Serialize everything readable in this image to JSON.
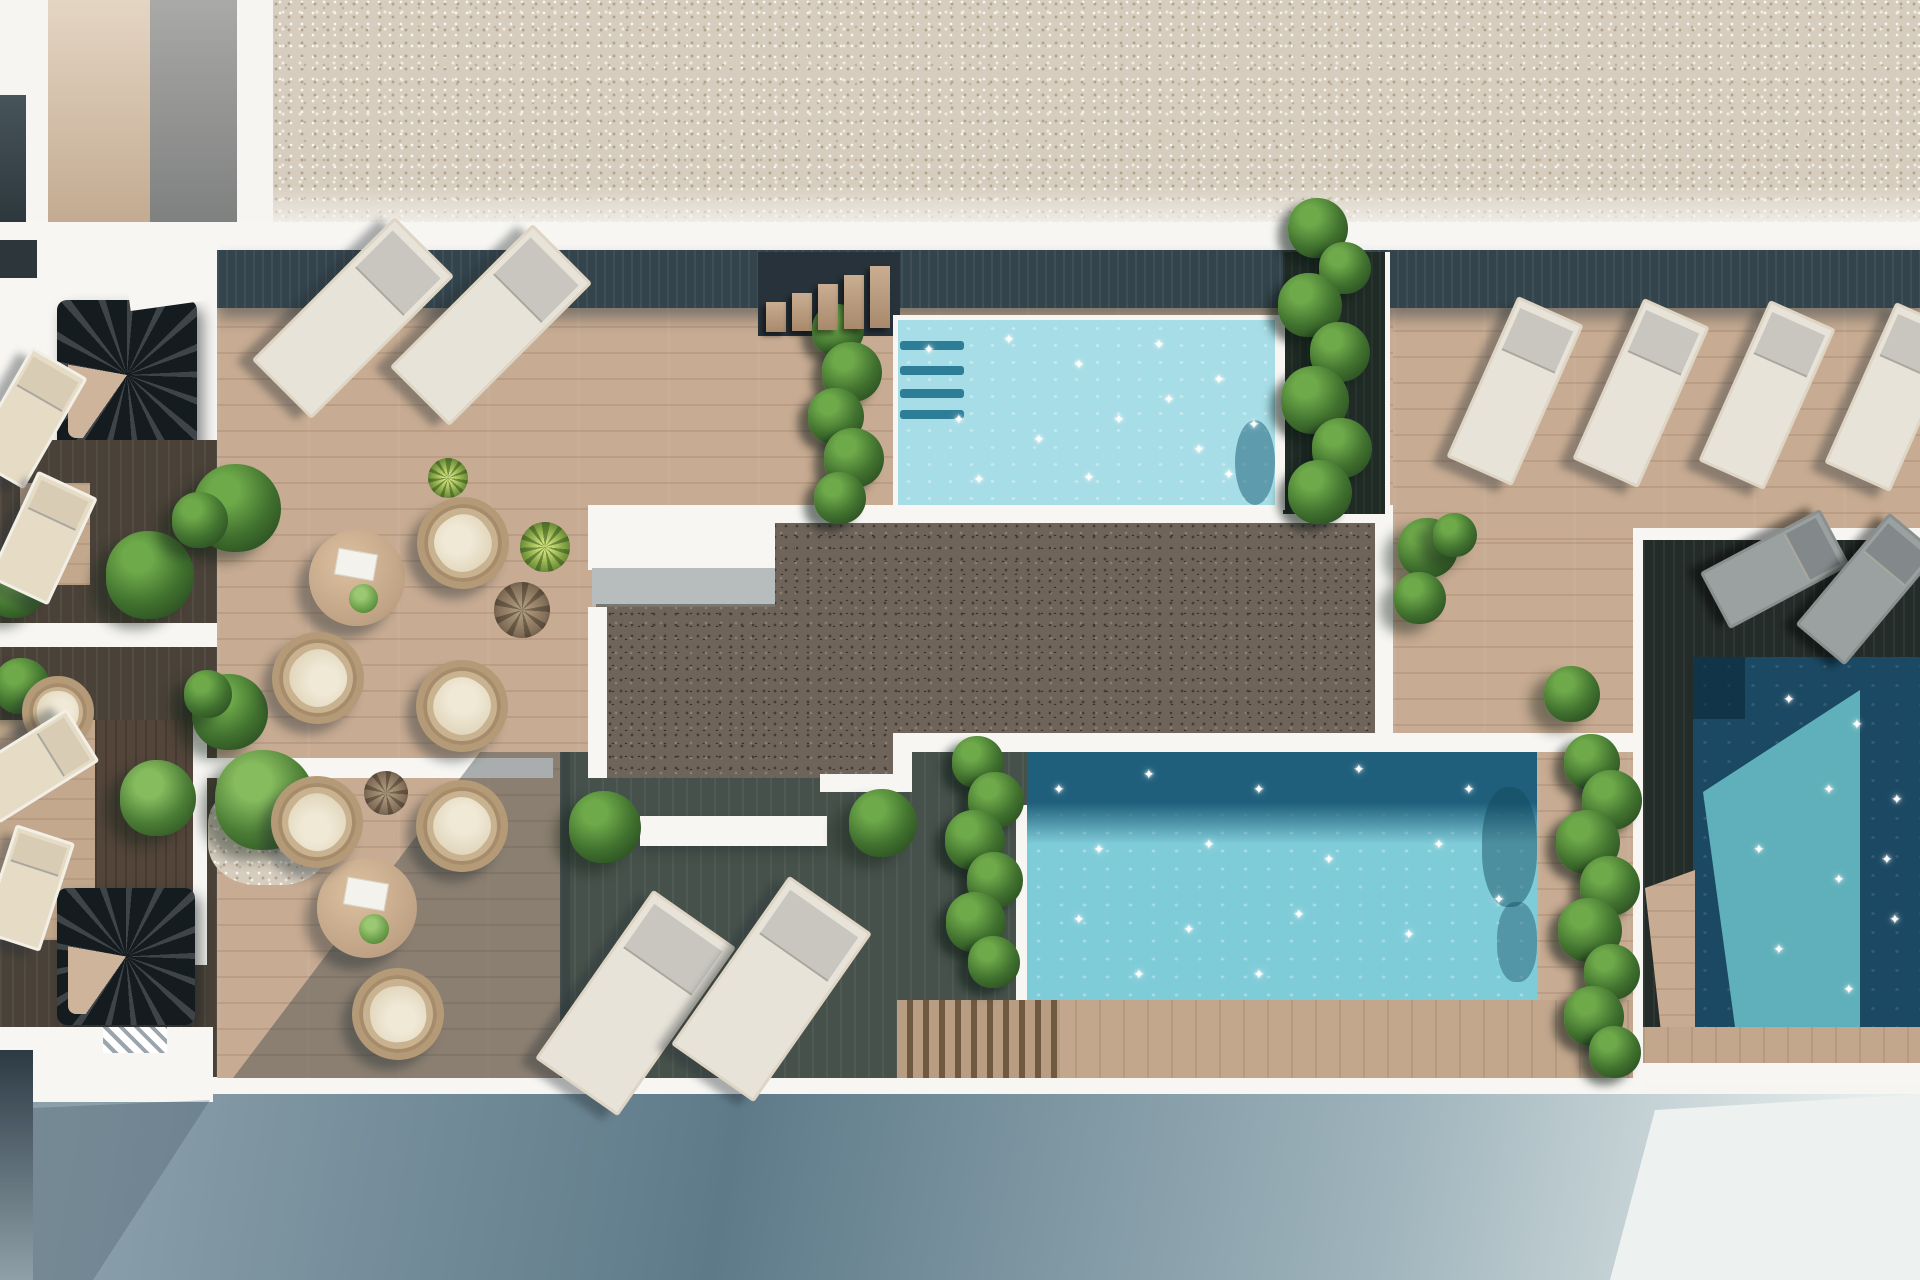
{
  "scene": {
    "kind": "3d-architectural-render",
    "view": "top-down-rooftop-terrace-with-pools"
  },
  "palette": {
    "white": "#f7f6f3",
    "gravelTop": "#d6cdbe",
    "gravelDark": "#6f645a",
    "wood": "#c7ab92",
    "woodShadowBand": "#33444c",
    "darkDeck": "#46514b",
    "rightDeckDark": "#242c29",
    "leftDeckDark": "#4a4238",
    "pool1Water": "#a6dde6",
    "poolStep": "#2d7d96",
    "pool2Water": "#7fccd9",
    "pool2ShadowBand": "#1f5f7b",
    "pool3Water": "#1b4862",
    "pool3Sunlit": "#5fb0ba",
    "plantGreen": "#41722f",
    "plantLight": "#6ea94a",
    "planterDark": "#202b26",
    "cushionCream": "#e6dcc6",
    "wicker": "#c9b28f",
    "loungerPad": "#e7e3d9",
    "loungerGray": "#9ba1a0",
    "streetDark": "#5e7a89",
    "streetLight": "#e7edec",
    "stripTan": "#c9b29c",
    "stripGray": "#8f9090",
    "windowDark": "#2c3a44"
  },
  "furniture": {
    "loungers": [
      {
        "x": 350,
        "y": 315,
        "w": 78,
        "h": 196,
        "rot": 45,
        "kind": "white"
      },
      {
        "x": 488,
        "y": 322,
        "w": 78,
        "h": 196,
        "rot": 45,
        "kind": "white"
      },
      {
        "x": 632,
        "y": 1000,
        "w": 95,
        "h": 200,
        "rot": 35,
        "kind": "white"
      },
      {
        "x": 768,
        "y": 986,
        "w": 95,
        "h": 200,
        "rot": 35,
        "kind": "white"
      },
      {
        "x": 1512,
        "y": 388,
        "w": 66,
        "h": 170,
        "rot": 24,
        "kind": "white"
      },
      {
        "x": 1638,
        "y": 390,
        "w": 66,
        "h": 170,
        "rot": 24,
        "kind": "white"
      },
      {
        "x": 1764,
        "y": 392,
        "w": 66,
        "h": 170,
        "rot": 24,
        "kind": "white"
      },
      {
        "x": 1890,
        "y": 394,
        "w": 66,
        "h": 170,
        "rot": 24,
        "kind": "white"
      },
      {
        "x": 25,
        "y": 415,
        "w": 58,
        "h": 122,
        "rot": 30,
        "kind": "cream"
      },
      {
        "x": 40,
        "y": 535,
        "w": 60,
        "h": 112,
        "rot": 25,
        "kind": "cream"
      },
      {
        "x": 30,
        "y": 763,
        "w": 56,
        "h": 112,
        "rot": 58,
        "kind": "cream"
      },
      {
        "x": 25,
        "y": 885,
        "w": 56,
        "h": 108,
        "rot": 18,
        "kind": "cream"
      },
      {
        "x": 1772,
        "y": 566,
        "w": 58,
        "h": 130,
        "rot": 62,
        "kind": "gray"
      },
      {
        "x": 1864,
        "y": 586,
        "w": 58,
        "h": 140,
        "rot": 40,
        "kind": "gray"
      }
    ],
    "chairs": [
      {
        "x": 463,
        "y": 543,
        "r": 46,
        "rot": -35
      },
      {
        "x": 318,
        "y": 678,
        "r": 46,
        "rot": 140
      },
      {
        "x": 462,
        "y": 706,
        "r": 46,
        "rot": 35
      },
      {
        "x": 317,
        "y": 822,
        "r": 46,
        "rot": -140
      },
      {
        "x": 462,
        "y": 826,
        "r": 46,
        "rot": 40
      },
      {
        "x": 398,
        "y": 1014,
        "r": 46,
        "rot": 175
      },
      {
        "x": 58,
        "y": 712,
        "r": 36,
        "rot": 90
      }
    ],
    "tables": [
      {
        "x": 357,
        "y": 578,
        "r": 48
      },
      {
        "x": 367,
        "y": 908,
        "r": 50
      }
    ]
  },
  "vegetation": {
    "bushes": [
      {
        "x": 237,
        "y": 508,
        "r": 44
      },
      {
        "x": 230,
        "y": 712,
        "r": 38
      },
      {
        "x": 605,
        "y": 827,
        "r": 36
      },
      {
        "x": 883,
        "y": 823,
        "r": 34
      },
      {
        "x": 1428,
        "y": 548,
        "r": 30
      },
      {
        "x": 1420,
        "y": 598,
        "r": 26
      },
      {
        "x": 1572,
        "y": 694,
        "r": 28
      },
      {
        "x": 150,
        "y": 575,
        "r": 44
      },
      {
        "x": 200,
        "y": 520,
        "r": 28
      },
      {
        "x": 15,
        "y": 588,
        "r": 30
      },
      {
        "x": 22,
        "y": 686,
        "r": 28
      },
      {
        "x": 208,
        "y": 694,
        "r": 24
      },
      {
        "x": 158,
        "y": 798,
        "r": 38,
        "kind": "tree"
      },
      {
        "x": 265,
        "y": 800,
        "r": 50,
        "kind": "tree"
      },
      {
        "x": 1455,
        "y": 535,
        "r": 22
      }
    ],
    "smallPlants": [
      {
        "x": 545,
        "y": 547,
        "r": 25,
        "kind": "aloe"
      },
      {
        "x": 448,
        "y": 478,
        "r": 20,
        "kind": "aloe"
      },
      {
        "x": 522,
        "y": 610,
        "r": 28,
        "kind": "dry"
      },
      {
        "x": 386,
        "y": 793,
        "r": 22,
        "kind": "dry"
      }
    ],
    "vineColumns": [
      {
        "name": "pool1-left",
        "blobs": [
          [
            838,
            330,
            26
          ],
          [
            852,
            372,
            30
          ],
          [
            836,
            416,
            28
          ],
          [
            854,
            458,
            30
          ],
          [
            840,
            498,
            26
          ]
        ]
      },
      {
        "name": "pool1-right",
        "blobs": [
          [
            1318,
            228,
            30
          ],
          [
            1345,
            268,
            26
          ],
          [
            1310,
            305,
            32
          ],
          [
            1340,
            352,
            30
          ],
          [
            1315,
            400,
            34
          ],
          [
            1342,
            448,
            30
          ],
          [
            1320,
            492,
            32
          ]
        ]
      },
      {
        "name": "pool2-left",
        "blobs": [
          [
            978,
            762,
            26
          ],
          [
            996,
            800,
            28
          ],
          [
            975,
            840,
            30
          ],
          [
            995,
            880,
            28
          ],
          [
            976,
            922,
            30
          ],
          [
            994,
            962,
            26
          ]
        ]
      },
      {
        "name": "pool2-right",
        "blobs": [
          [
            1592,
            762,
            28
          ],
          [
            1612,
            800,
            30
          ],
          [
            1588,
            842,
            32
          ],
          [
            1610,
            886,
            30
          ],
          [
            1590,
            930,
            32
          ],
          [
            1612,
            972,
            28
          ],
          [
            1594,
            1016,
            30
          ],
          [
            1615,
            1052,
            26
          ]
        ]
      }
    ]
  },
  "pools": {
    "pool1": {
      "stepBars": [
        341,
        366,
        389,
        410
      ]
    },
    "sparkles": {
      "pool1": [
        [
          930,
          350
        ],
        [
          1010,
          340
        ],
        [
          1080,
          365
        ],
        [
          1160,
          345
        ],
        [
          1220,
          380
        ],
        [
          960,
          420
        ],
        [
          1040,
          440
        ],
        [
          1120,
          420
        ],
        [
          1200,
          450
        ],
        [
          980,
          480
        ],
        [
          1090,
          478
        ],
        [
          1230,
          475
        ],
        [
          1170,
          400
        ],
        [
          1255,
          425
        ]
      ],
      "pool2": [
        [
          1060,
          790
        ],
        [
          1150,
          775
        ],
        [
          1260,
          790
        ],
        [
          1360,
          770
        ],
        [
          1470,
          790
        ],
        [
          1100,
          850
        ],
        [
          1210,
          845
        ],
        [
          1330,
          860
        ],
        [
          1440,
          845
        ],
        [
          1080,
          920
        ],
        [
          1190,
          930
        ],
        [
          1300,
          915
        ],
        [
          1410,
          935
        ],
        [
          1500,
          900
        ],
        [
          1140,
          975
        ],
        [
          1260,
          975
        ]
      ],
      "pool3": [
        [
          1790,
          700
        ],
        [
          1858,
          725
        ],
        [
          1830,
          790
        ],
        [
          1898,
          800
        ],
        [
          1760,
          850
        ],
        [
          1840,
          880
        ],
        [
          1896,
          920
        ],
        [
          1780,
          950
        ],
        [
          1850,
          990
        ],
        [
          1888,
          860
        ]
      ]
    }
  },
  "stairs": {
    "topTreads": [
      {
        "left": 766,
        "top": 302,
        "h": 30
      },
      {
        "left": 792,
        "top": 293,
        "h": 38
      },
      {
        "left": 818,
        "top": 284,
        "h": 46
      },
      {
        "left": 844,
        "top": 275,
        "h": 54
      },
      {
        "left": 870,
        "top": 266,
        "h": 62
      }
    ]
  }
}
